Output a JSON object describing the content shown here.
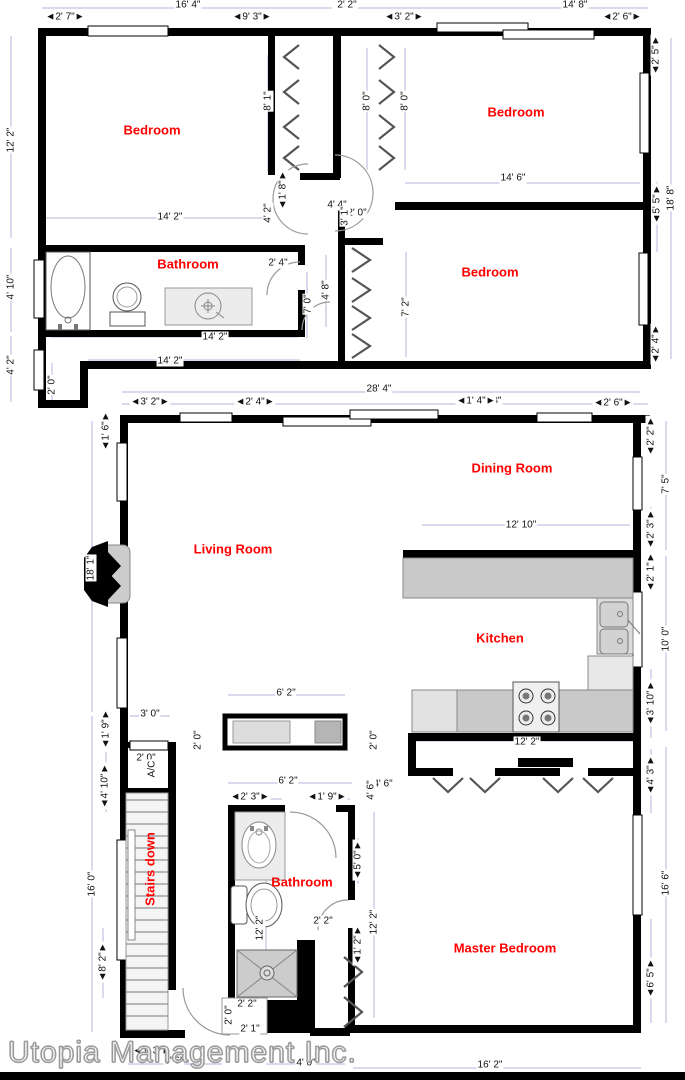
{
  "floorplan": {
    "company": "Utopia Management Inc.",
    "accent_color": "#ff0000",
    "dim_color": "#b4b4dc",
    "rooms": [
      {
        "label": "Bedroom",
        "x": 152,
        "y": 130,
        "rot": 0
      },
      {
        "label": "Bedroom",
        "x": 516,
        "y": 112,
        "rot": 0
      },
      {
        "label": "Bathroom",
        "x": 188,
        "y": 264,
        "rot": 0
      },
      {
        "label": "Bedroom",
        "x": 490,
        "y": 272,
        "rot": 0
      },
      {
        "label": "Dining Room",
        "x": 512,
        "y": 468,
        "rot": 0
      },
      {
        "label": "Living Room",
        "x": 233,
        "y": 549,
        "rot": 0
      },
      {
        "label": "Kitchen",
        "x": 500,
        "y": 638,
        "rot": 0
      },
      {
        "label": "Stairs down",
        "x": 150,
        "y": 869,
        "rot": 1
      },
      {
        "label": "Bathroom",
        "x": 302,
        "y": 882,
        "rot": 0
      },
      {
        "label": "Master Bedroom",
        "x": 505,
        "y": 948,
        "rot": 0
      }
    ],
    "dim_labels": [
      {
        "t": "16' 4\"",
        "x": 188,
        "y": 5,
        "rot": 0
      },
      {
        "t": "2' 2\"",
        "x": 347,
        "y": 5,
        "rot": 0
      },
      {
        "t": "14' 8\"",
        "x": 575,
        "y": 5,
        "rot": 0
      },
      {
        "t": "◄2' 7\"►",
        "x": 65,
        "y": 17,
        "rot": 0
      },
      {
        "t": "◄9' 3\"►",
        "x": 252,
        "y": 17,
        "rot": 0
      },
      {
        "t": "◄3' 2\"►",
        "x": 404,
        "y": 17,
        "rot": 0
      },
      {
        "t": "◄2' 6\"►",
        "x": 622,
        "y": 17,
        "rot": 0
      },
      {
        "t": "12' 2\"",
        "x": 11,
        "y": 140,
        "rot": 1
      },
      {
        "t": "◄2' 5\"►",
        "x": 656,
        "y": 55,
        "rot": 1
      },
      {
        "t": "18' 8\"",
        "x": 671,
        "y": 198,
        "rot": 1
      },
      {
        "t": "8' 1\"",
        "x": 268,
        "y": 101,
        "rot": 1
      },
      {
        "t": "8' 0\"",
        "x": 367,
        "y": 101,
        "rot": 1
      },
      {
        "t": "8' 0\"",
        "x": 405,
        "y": 101,
        "rot": 1
      },
      {
        "t": "◄1' 8\"►",
        "x": 283,
        "y": 190,
        "rot": 1
      },
      {
        "t": "14' 6\"",
        "x": 513,
        "y": 178,
        "rot": 0
      },
      {
        "t": "4' 4\"",
        "x": 337,
        "y": 205,
        "rot": 0
      },
      {
        "t": "2' 0\"",
        "x": 357,
        "y": 213,
        "rot": 0
      },
      {
        "t": "3' 1\"",
        "x": 345,
        "y": 216,
        "rot": 1
      },
      {
        "t": "◄5' 5\"►",
        "x": 657,
        "y": 204,
        "rot": 1
      },
      {
        "t": "14' 2\"",
        "x": 170,
        "y": 217,
        "rot": 0
      },
      {
        "t": "4' 2\"",
        "x": 268,
        "y": 213,
        "rot": 1
      },
      {
        "t": "2' 4\"",
        "x": 278,
        "y": 263,
        "rot": 0
      },
      {
        "t": "4' 8\"",
        "x": 326,
        "y": 290,
        "rot": 1
      },
      {
        "t": "7' 0\"",
        "x": 308,
        "y": 304,
        "rot": 1
      },
      {
        "t": "7' 2\"",
        "x": 406,
        "y": 307,
        "rot": 1
      },
      {
        "t": "◄2' 4\"►",
        "x": 656,
        "y": 344,
        "rot": 1
      },
      {
        "t": "4' 10\"",
        "x": 11,
        "y": 287,
        "rot": 1
      },
      {
        "t": "14' 2\"",
        "x": 215,
        "y": 337,
        "rot": 0
      },
      {
        "t": "14' 2\"",
        "x": 170,
        "y": 361,
        "rot": 0
      },
      {
        "t": "4' 2\"",
        "x": 11,
        "y": 365,
        "rot": 1
      },
      {
        "t": "2' 0\"",
        "x": 52,
        "y": 385,
        "rot": 1
      },
      {
        "t": "28' 4\"",
        "x": 379,
        "y": 389,
        "rot": 0
      },
      {
        "t": "46' 8\"",
        "x": 489,
        "y": 401,
        "rot": 0
      },
      {
        "t": "◄1' 4\"►",
        "x": 476,
        "y": 401,
        "rot": 0
      },
      {
        "t": "◄2' 6\"►",
        "x": 613,
        "y": 403,
        "rot": 0
      },
      {
        "t": "◄3' 2\"►",
        "x": 150,
        "y": 402,
        "rot": 0
      },
      {
        "t": "◄2' 4\"►",
        "x": 255,
        "y": 402,
        "rot": 0
      },
      {
        "t": "◄1' 6\"►",
        "x": 106,
        "y": 431,
        "rot": 1
      },
      {
        "t": "18' 1\"",
        "x": 91,
        "y": 568,
        "rot": 1
      },
      {
        "t": "◄2' 2\"►",
        "x": 651,
        "y": 436,
        "rot": 1
      },
      {
        "t": "7' 5\"",
        "x": 666,
        "y": 484,
        "rot": 1
      },
      {
        "t": "12' 10\"",
        "x": 521,
        "y": 525,
        "rot": 0
      },
      {
        "t": "◄2' 3\"►",
        "x": 651,
        "y": 529,
        "rot": 1
      },
      {
        "t": "◄2' 1\"►",
        "x": 651,
        "y": 572,
        "rot": 1
      },
      {
        "t": "10' 0\"",
        "x": 666,
        "y": 639,
        "rot": 1
      },
      {
        "t": "◄3' 10\"►",
        "x": 651,
        "y": 703,
        "rot": 1
      },
      {
        "t": "12' 2\"",
        "x": 527,
        "y": 742,
        "rot": 0
      },
      {
        "t": "6' 2\"",
        "x": 286,
        "y": 693,
        "rot": 0
      },
      {
        "t": "2' 0\"",
        "x": 198,
        "y": 740,
        "rot": 1
      },
      {
        "t": "2' 0\"",
        "x": 374,
        "y": 740,
        "rot": 1
      },
      {
        "t": "3' 0\"",
        "x": 150,
        "y": 714,
        "rot": 0
      },
      {
        "t": "◄1' 9\"►",
        "x": 106,
        "y": 729,
        "rot": 1
      },
      {
        "t": "2' 0\"",
        "x": 146,
        "y": 758,
        "rot": 0
      },
      {
        "t": "A/C",
        "x": 152,
        "y": 769,
        "rot": 1
      },
      {
        "t": "◄4' 10\"►",
        "x": 105,
        "y": 786,
        "rot": 1
      },
      {
        "t": "16' 0\"",
        "x": 92,
        "y": 884,
        "rot": 1
      },
      {
        "t": "◄8' 2\"►",
        "x": 103,
        "y": 962,
        "rot": 1
      },
      {
        "t": "6' 2\"",
        "x": 288,
        "y": 781,
        "rot": 0
      },
      {
        "t": "◄2' 3\"►",
        "x": 250,
        "y": 797,
        "rot": 0
      },
      {
        "t": "◄1' 9\"►",
        "x": 327,
        "y": 797,
        "rot": 0
      },
      {
        "t": "12' 2\"",
        "x": 260,
        "y": 928,
        "rot": 1
      },
      {
        "t": "◄5' 0\"►",
        "x": 358,
        "y": 860,
        "rot": 1
      },
      {
        "t": "4' 6\"",
        "x": 383,
        "y": 784,
        "rot": 0
      },
      {
        "t": "4' 6\"",
        "x": 371,
        "y": 790,
        "rot": 1
      },
      {
        "t": "◄4' 3\"►",
        "x": 651,
        "y": 775,
        "rot": 1
      },
      {
        "t": "16' 6\"",
        "x": 666,
        "y": 883,
        "rot": 1
      },
      {
        "t": "◄6' 5\"►",
        "x": 651,
        "y": 978,
        "rot": 1
      },
      {
        "t": "◄1' 2\"►",
        "x": 358,
        "y": 945,
        "rot": 1
      },
      {
        "t": "12' 2\"",
        "x": 374,
        "y": 922,
        "rot": 1
      },
      {
        "t": "2' 2\"",
        "x": 323,
        "y": 921,
        "rot": 0
      },
      {
        "t": "2' 2\"",
        "x": 247,
        "y": 1004,
        "rot": 0
      },
      {
        "t": "2' 0\"",
        "x": 229,
        "y": 1015,
        "rot": 1
      },
      {
        "t": "2' 1\"",
        "x": 250,
        "y": 1029,
        "rot": 0
      },
      {
        "t": "◄1' 3\"►",
        "x": 152,
        "y": 1051,
        "rot": 0
      },
      {
        "t": "6' 6\"",
        "x": 174,
        "y": 1061,
        "rot": 0
      },
      {
        "t": "4' 0\"",
        "x": 306,
        "y": 1063,
        "rot": 0
      },
      {
        "t": "16' 2\"",
        "x": 490,
        "y": 1065,
        "rot": 0
      }
    ]
  }
}
